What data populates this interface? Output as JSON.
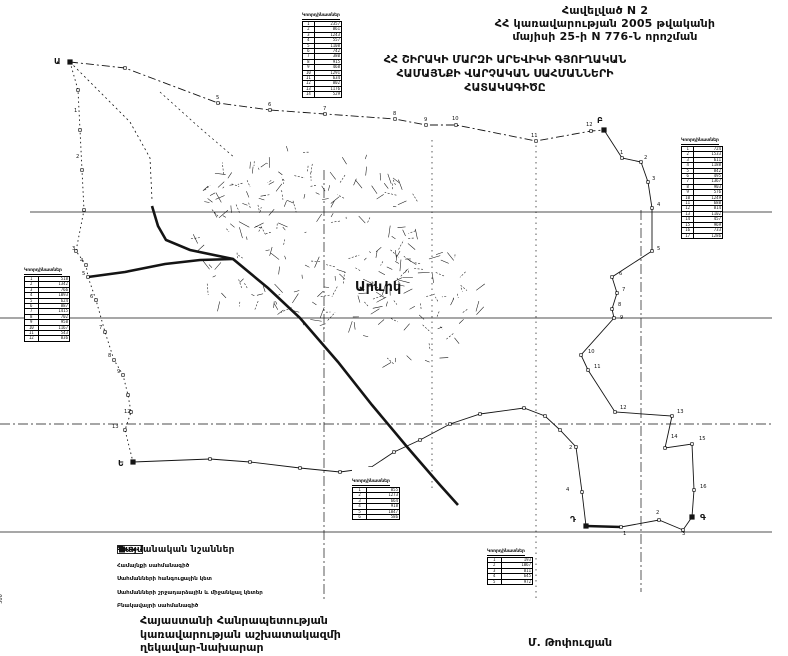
{
  "header": {
    "appendix": "Հավելված N 2",
    "line2": "ՀՀ կառավարության 2005 թվականի",
    "line3": "մայիսի 25-ի N 776-Ն որոշման"
  },
  "title": {
    "line1": "ՀՀ ՇԻՐԱԿԻ ՄԱՐԶԻ ԱՐԵՎԻԿԻ ԳՅՈՒՂԱԿԱՆ",
    "line2": "ՀԱՄԱՅՆՔԻ  ՎԱՐՉԱԿԱՆ  ՍԱՀՄԱՆՆԵՐԻ",
    "line3": "ՀԱՏԱԿԱԳԻԾԸ"
  },
  "map": {
    "settlement_label": "Արևիկ",
    "scale_label": "500",
    "junctions": [
      {
        "label": "Ա",
        "x": 54,
        "y": 64,
        "px": 70,
        "py": 62
      },
      {
        "label": "Բ",
        "x": 597,
        "y": 123,
        "px": 604,
        "py": 130
      },
      {
        "label": "Գ",
        "x": 700,
        "y": 520,
        "px": 692,
        "py": 517
      },
      {
        "label": "Դ",
        "x": 570,
        "y": 522,
        "px": 586,
        "py": 526
      },
      {
        "label": "Ե",
        "x": 118,
        "y": 466,
        "px": 133,
        "py": 462
      }
    ],
    "point_labels": [
      {
        "t": "5",
        "x": 216,
        "y": 99
      },
      {
        "t": "6",
        "x": 268,
        "y": 106
      },
      {
        "t": "7",
        "x": 323,
        "y": 110
      },
      {
        "t": "8",
        "x": 393,
        "y": 115
      },
      {
        "t": "9",
        "x": 424,
        "y": 121
      },
      {
        "t": "10",
        "x": 452,
        "y": 120
      },
      {
        "t": "11",
        "x": 531,
        "y": 137
      },
      {
        "t": "12",
        "x": 586,
        "y": 126
      },
      {
        "t": "1",
        "x": 620,
        "y": 154
      },
      {
        "t": "2",
        "x": 644,
        "y": 159
      },
      {
        "t": "3",
        "x": 652,
        "y": 180
      },
      {
        "t": "4",
        "x": 657,
        "y": 206
      },
      {
        "t": "5",
        "x": 657,
        "y": 250
      },
      {
        "t": "6",
        "x": 619,
        "y": 275
      },
      {
        "t": "7",
        "x": 622,
        "y": 291
      },
      {
        "t": "8",
        "x": 618,
        "y": 306
      },
      {
        "t": "9",
        "x": 620,
        "y": 319
      },
      {
        "t": "10",
        "x": 588,
        "y": 353
      },
      {
        "t": "11",
        "x": 594,
        "y": 368
      },
      {
        "t": "12",
        "x": 620,
        "y": 409
      },
      {
        "t": "13",
        "x": 677,
        "y": 413
      },
      {
        "t": "14",
        "x": 671,
        "y": 438
      },
      {
        "t": "15",
        "x": 699,
        "y": 440
      },
      {
        "t": "16",
        "x": 700,
        "y": 488
      },
      {
        "t": "1",
        "x": 623,
        "y": 535
      },
      {
        "t": "2",
        "x": 656,
        "y": 514
      },
      {
        "t": "3",
        "x": 682,
        "y": 535
      },
      {
        "t": "2",
        "x": 569,
        "y": 449
      },
      {
        "t": "4",
        "x": 566,
        "y": 491
      },
      {
        "t": "1",
        "x": 74,
        "y": 112
      },
      {
        "t": "2",
        "x": 76,
        "y": 158
      },
      {
        "t": "3",
        "x": 72,
        "y": 250
      },
      {
        "t": "4",
        "x": 80,
        "y": 262
      },
      {
        "t": "5",
        "x": 82,
        "y": 275
      },
      {
        "t": "6",
        "x": 90,
        "y": 298
      },
      {
        "t": "7",
        "x": 99,
        "y": 329
      },
      {
        "t": "8",
        "x": 108,
        "y": 357
      },
      {
        "t": "9",
        "x": 117,
        "y": 373
      },
      {
        "t": "12",
        "x": 124,
        "y": 413
      },
      {
        "t": "13",
        "x": 112,
        "y": 428
      }
    ]
  },
  "tables": [
    {
      "title": "Կոորդինատներ",
      "rows": [
        [
          "1",
          "2357"
        ],
        [
          "2",
          "861"
        ],
        [
          "3",
          "1243"
        ],
        [
          "4",
          "557"
        ],
        [
          "5",
          "1108"
        ],
        [
          "6",
          "742"
        ],
        [
          "7",
          "380"
        ],
        [
          "8",
          "915"
        ],
        [
          "9",
          "468"
        ],
        [
          "10",
          "1291"
        ],
        [
          "11",
          "634"
        ],
        [
          "12",
          "802"
        ],
        [
          "13",
          "1176"
        ],
        [
          "14",
          "529"
        ]
      ]
    },
    {
      "title": "Կոորդինատներ",
      "rows": [
        [
          "1",
          "724"
        ],
        [
          "2",
          "1533"
        ],
        [
          "3",
          "611"
        ],
        [
          "4",
          "1188"
        ],
        [
          "5",
          "842"
        ],
        [
          "6",
          "495"
        ],
        [
          "7",
          "1367"
        ],
        [
          "8",
          "903"
        ],
        [
          "9",
          "576"
        ],
        [
          "10",
          "1249"
        ],
        [
          "11",
          "688"
        ],
        [
          "12",
          "814"
        ],
        [
          "13",
          "1102"
        ],
        [
          "14",
          "457"
        ],
        [
          "15",
          "969"
        ],
        [
          "16",
          "733"
        ],
        [
          "17",
          "1286"
        ]
      ]
    },
    {
      "title": "Կոորդինատներ",
      "rows": [
        [
          "1",
          "518"
        ],
        [
          "2",
          "1342"
        ],
        [
          "3",
          "766"
        ],
        [
          "4",
          "1093"
        ],
        [
          "5",
          "624"
        ],
        [
          "6",
          "887"
        ],
        [
          "7",
          "1415"
        ],
        [
          "8",
          "702"
        ],
        [
          "9",
          "958"
        ],
        [
          "10",
          "1167"
        ],
        [
          "11",
          "543"
        ],
        [
          "12",
          "836"
        ]
      ]
    },
    {
      "title": "Կոորդինատներ",
      "rows": [
        [
          "1",
          "855"
        ],
        [
          "2",
          "1273"
        ],
        [
          "3",
          "664"
        ],
        [
          "4",
          "918"
        ],
        [
          "5",
          "1047"
        ],
        [
          "6",
          "586"
        ]
      ]
    },
    {
      "title": "Կոորդինատներ",
      "rows": [
        [
          "1",
          "193"
        ],
        [
          "2",
          "1067"
        ],
        [
          "3",
          "811"
        ],
        [
          "4",
          "645"
        ],
        [
          "5",
          "972"
        ]
      ]
    }
  ],
  "legend": {
    "title": "Պայմանական նշաններ",
    "items": [
      {
        "symbol": "community-boundary-line",
        "label": "Համայնքի սահմանագիծ"
      },
      {
        "symbol": "boundary-junction-point",
        "label": "Սահմանների հանգուցային կետ"
      },
      {
        "symbol": "boundary-turn-points",
        "label": "Սահմանների շրջադարձային և միջանկյալ կետեր"
      },
      {
        "symbol": "settlement-boundary-line",
        "label": "Բնակավայրի սահմանագիծ"
      }
    ]
  },
  "footer": {
    "line1": "Հայաստանի Հանրապետության",
    "line2": "կառավարության աշխատակազմի",
    "line3": "ղեկավար-նախարար",
    "signature": "Մ. Թոփուզյան"
  },
  "colors": {
    "ink": "#141414"
  }
}
